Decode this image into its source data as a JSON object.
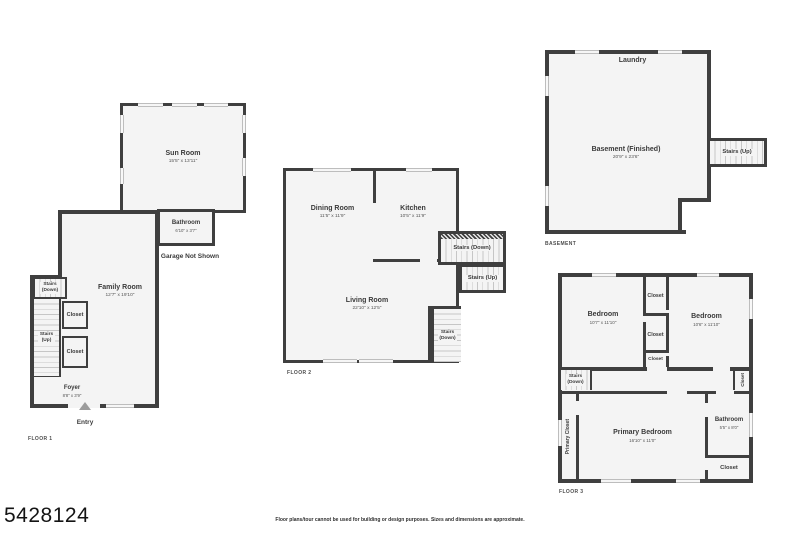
{
  "page": {
    "listing_id": "5428124",
    "disclaimer": "Floor plans/tour cannot be used for building or design purposes. Sizes and dimensions are approximate."
  },
  "colors": {
    "wall": "#3f3f3f",
    "room_fill": "#f4f4f4",
    "text": "#3a3a3a"
  },
  "floor1": {
    "label": "FLOOR 1",
    "sun_room": {
      "name": "Sun Room",
      "dims": "15'5\" x 13'11\""
    },
    "bathroom": {
      "name": "Bathroom",
      "dims": "6'10\" x 3'7\""
    },
    "garage_note": "Garage Not Shown",
    "family_room": {
      "name": "Family Room",
      "dims": "12'7\" x 19'10\""
    },
    "stairs_down": {
      "line1": "Stairs",
      "line2": "(Down)"
    },
    "stairs_up": {
      "line1": "Stairs",
      "line2": "(Up)"
    },
    "closet_upper": "Closet",
    "closet_lower": "Closet",
    "foyer": {
      "name": "Foyer",
      "dims": "8'8\" x 3'9\""
    },
    "entry": "Entry"
  },
  "floor2": {
    "label": "FLOOR 2",
    "dining_room": {
      "name": "Dining Room",
      "dims": "11'5\" x 11'9\""
    },
    "kitchen": {
      "name": "Kitchen",
      "dims": "10'5\" x 11'9\""
    },
    "living_room": {
      "name": "Living Room",
      "dims": "22'10\" x 12'5\""
    },
    "stairs_down_upper": "Stairs (Down)",
    "stairs_up": "Stairs (Up)",
    "stairs_down_lower": {
      "line1": "Stairs",
      "line2": "(Down)"
    }
  },
  "basement": {
    "label": "BASEMENT",
    "laundry": "Laundry",
    "main_room": {
      "name": "Basement (Finished)",
      "dims": "20'9\" x 23'6\""
    },
    "stairs_up": "Stairs (Up)"
  },
  "floor3": {
    "label": "FLOOR 3",
    "bedroom_left": {
      "name": "Bedroom",
      "dims": "10'7\" x 11'10\""
    },
    "bedroom_right": {
      "name": "Bedroom",
      "dims": "10'6\" x 11'10\""
    },
    "closet_top": "Closet",
    "closet_mid": "Closet",
    "closet_small": "Closet",
    "stairs_down": {
      "line1": "Stairs",
      "line2": "(Down)"
    },
    "hall_closet": "Closet",
    "primary_closet": "Primary Closet",
    "primary_bedroom": {
      "name": "Primary Bedroom",
      "dims": "16'10\" x 11'0\""
    },
    "bathroom": {
      "name": "Bathroom",
      "dims": "5'5\" x 8'0\""
    },
    "closet_bottom": "Closet"
  }
}
